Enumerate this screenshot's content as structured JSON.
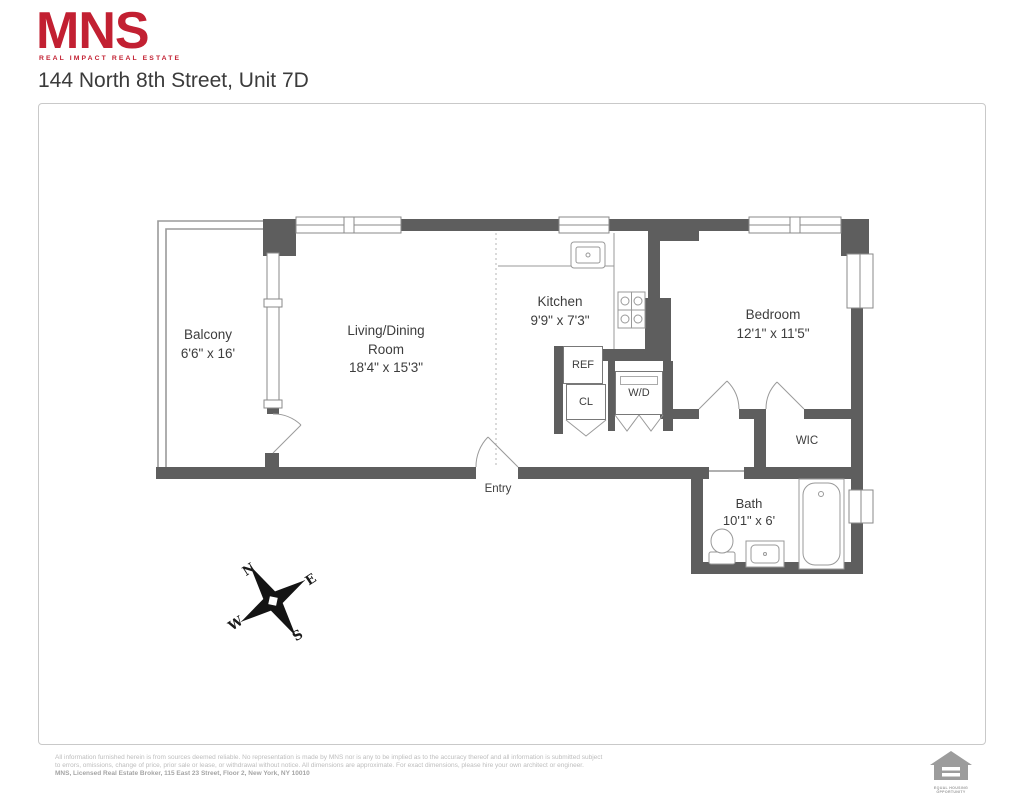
{
  "header": {
    "logo_text": "MNS",
    "logo_tagline": "REAL IMPACT REAL ESTATE",
    "title": "144 North 8th Street, Unit 7D"
  },
  "floorplan": {
    "rooms": {
      "balcony": {
        "name": "Balcony",
        "dims": "6'6\" x 16'"
      },
      "living": {
        "name": "Living/Dining\nRoom",
        "dims": "18'4\" x 15'3\""
      },
      "kitchen": {
        "name": "Kitchen",
        "dims": "9'9\" x 7'3\""
      },
      "bedroom": {
        "name": "Bedroom",
        "dims": "12'1\" x 11'5\""
      },
      "bath": {
        "name": "Bath",
        "dims": "10'1\" x 6'"
      },
      "wic": {
        "name": "WIC"
      },
      "entry": {
        "name": "Entry"
      },
      "ref": {
        "name": "REF"
      },
      "cl": {
        "name": "CL"
      },
      "wd": {
        "name": "W/D"
      }
    },
    "compass": {
      "n": "N",
      "e": "E",
      "s": "S",
      "w": "W"
    }
  },
  "footer": {
    "disclaimer_line1": "All information furnished herein is from sources deemed reliable. No representation is made by MNS nor is any to be implied as to the accuracy thereof and all information is submitted subject",
    "disclaimer_line2": "to errors, omissions, change of price, prior sale or lease, or withdrawal without notice. All dimensions are approximate. For exact dimensions, please hire your own architect or engineer.",
    "disclaimer_line3": "MNS, Licensed Real Estate Broker, 115 East 23 Street, Floor 2, New York, NY 10010",
    "eho_label": "EQUAL HOUSING\nOPPORTUNITY"
  },
  "colors": {
    "brand_red": "#c22032",
    "wall_gray": "#5e5e5e"
  }
}
